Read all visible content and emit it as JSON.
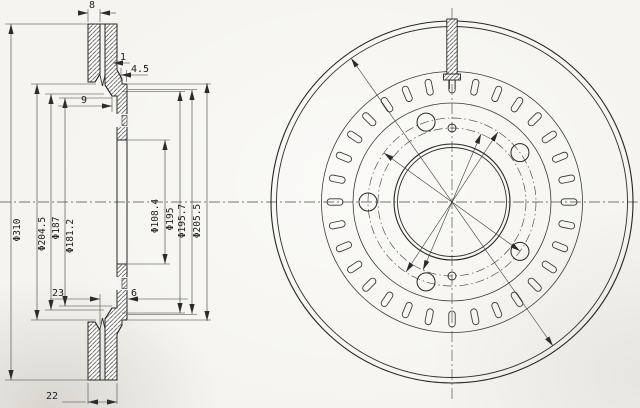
{
  "drawing": {
    "kind": "vented brake disc technical drawing",
    "section_view": {
      "dims": {
        "plate_width": "8",
        "lip": "1",
        "step": "4.5",
        "hub_offset": "9",
        "hat_depth": "23",
        "flange_width": "6",
        "total_thickness": "22"
      },
      "diameters_left": [
        "Φ310",
        "Φ204.5",
        "Φ187",
        "Φ181.2"
      ],
      "diameters_inner": [
        "Φ108.4",
        "Φ195",
        "Φ195.7",
        "Φ205.5"
      ]
    },
    "front_view": {
      "vent_slot_count": 32,
      "bolt_hole_angles_deg": [
        36,
        108,
        180,
        252,
        324
      ],
      "bolt_circle_radius": 84,
      "bolt_hole_radius": 9,
      "small_hole_angles_deg": [
        90,
        270
      ],
      "small_hole_circle_radius": 74,
      "small_hole_radius": 4,
      "center_x": 452,
      "center_y": 202,
      "slot_inner_radius": 109,
      "slot_outer_radius": 125,
      "slot_width": 6.4
    },
    "colors": {
      "line": "#262626",
      "thin_line": "#3c3c3c",
      "paper": "#f5f4f0"
    }
  }
}
